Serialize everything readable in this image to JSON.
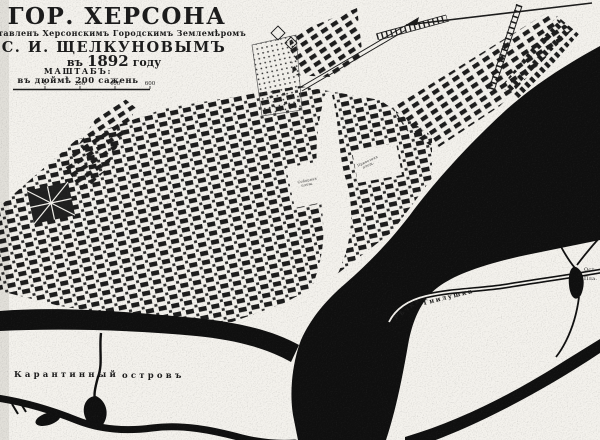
{
  "colors": {
    "paper": "#f4f2ed",
    "ink": "#1b1b1b",
    "water": "#0f0f0f",
    "block": "#1c1c1c"
  },
  "title_block": {
    "title": "ГОР. ХЕРСОНА",
    "line2": "составленъ Херсонскимъ Городскимъ Землемѣромъ",
    "line3": "С. И. ЩЕЛКУНОВЫМЪ",
    "line4_prefix": "въ",
    "line4_year": "1892",
    "line4_suffix": "году",
    "scale_title": "МАШТАБЪ:",
    "scale_units": "въ дюймѣ 200 сажень",
    "scale_ticks": [
      "0",
      "200",
      "400",
      "600"
    ]
  },
  "map_labels": {
    "island_word1": "Карантинный",
    "island_word2": "островъ",
    "river_word1": "Рѣчка",
    "river_word2": "Гнилушка",
    "square1_line1": "Соборная",
    "square1_line2": "площ.",
    "square2_line1": "Привозная",
    "square2_line2": "площ.",
    "edge_label1": "Ост.",
    "edge_label2": "Пла."
  }
}
